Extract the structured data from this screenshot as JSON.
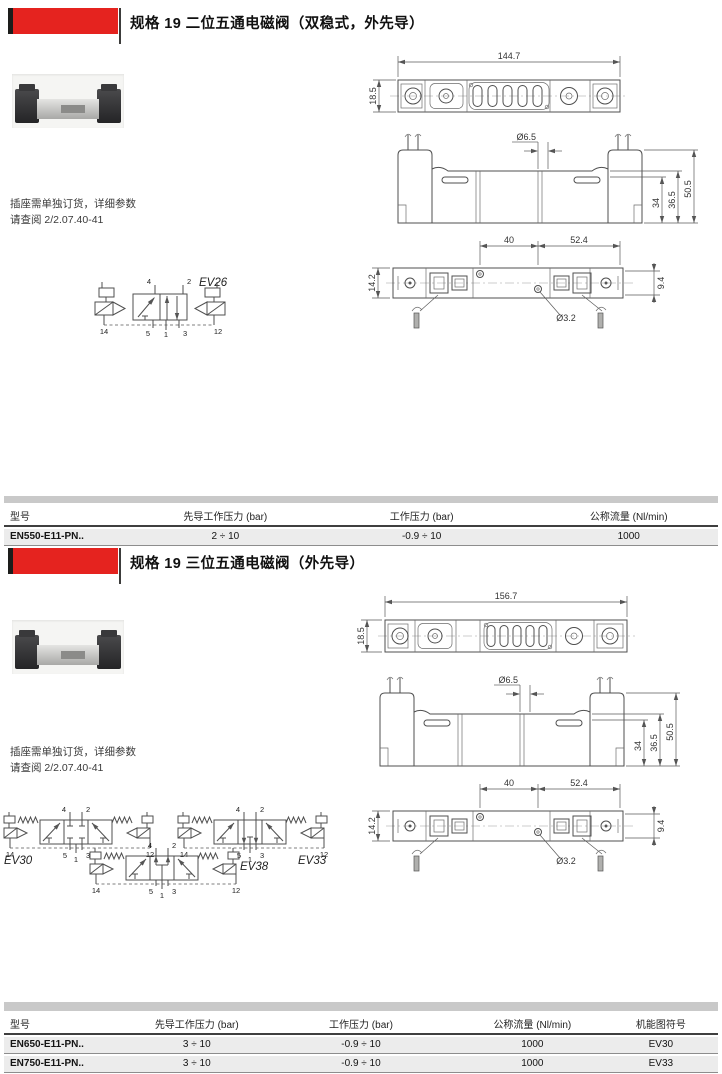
{
  "section1": {
    "title": "规格 19 二位五通电磁阀（双稳式，外先导）",
    "note": {
      "line1": "插座需单独订货，详细参数",
      "line2": "请查阅 2/2.07.40-41"
    },
    "symbol": {
      "label": "EV26",
      "ports_top": [
        "4",
        "2"
      ],
      "ports_bottom": [
        "14",
        "5",
        "1",
        "3",
        "12"
      ]
    },
    "dims": {
      "top_width": "144.7",
      "top_height": "18.5",
      "hole_top": "Ø6.5",
      "h_34": "34",
      "h_36_5": "36.5",
      "h_50_5": "50.5",
      "w_40": "40",
      "w_52_4": "52.4",
      "d_14_2": "14.2",
      "d_9_4": "9.4",
      "hole_bottom": "Ø3.2"
    },
    "table": {
      "headers": [
        "型号",
        "先导工作压力 (bar)",
        "工作压力 (bar)",
        "公称流量 (Nl/min)"
      ],
      "rows": [
        {
          "model": "EN550-E11-PN..",
          "pilot": "2 ÷ 10",
          "working": "-0.9 ÷ 10",
          "flow": "1000"
        }
      ]
    }
  },
  "section2": {
    "title": "规格 19 三位五通电磁阀（外先导）",
    "note": {
      "line1": "插座需单独订货，详细参数",
      "line2": "请查阅 2/2.07.40-41"
    },
    "symbols": [
      {
        "label": "EV30",
        "ports_top": [
          "4",
          "2"
        ],
        "ports_bottom": [
          "14",
          "5",
          "1",
          "3",
          "12"
        ]
      },
      {
        "label": "EV33",
        "ports_top": [
          "4",
          "2"
        ],
        "ports_bottom": [
          "14",
          "5",
          "1",
          "3",
          "12"
        ]
      },
      {
        "label": "EV38",
        "ports_top": [
          "4",
          "2"
        ],
        "ports_bottom": [
          "14",
          "5",
          "1",
          "3",
          "12"
        ]
      }
    ],
    "dims": {
      "top_width": "156.7",
      "top_height": "18.5",
      "hole_top": "Ø6.5",
      "h_34": "34",
      "h_36_5": "36.5",
      "h_50_5": "50.5",
      "w_40": "40",
      "w_52_4": "52.4",
      "d_14_2": "14.2",
      "d_9_4": "9.4",
      "hole_bottom": "Ø3.2"
    },
    "table": {
      "headers": [
        "型号",
        "先导工作压力 (bar)",
        "工作压力 (bar)",
        "公称流量 (Nl/min)",
        "机能图符号"
      ],
      "rows": [
        {
          "model": "EN650-E11-PN..",
          "pilot": "3 ÷ 10",
          "working": "-0.9 ÷ 10",
          "flow": "1000",
          "symbol": "EV30"
        },
        {
          "model": "EN750-E11-PN..",
          "pilot": "3 ÷ 10",
          "working": "-0.9 ÷ 10",
          "flow": "1000",
          "symbol": "EV33"
        },
        {
          "model": "EN850-E11-PN..",
          "pilot": "3 ÷ 10",
          "working": "-0.9 ÷ 10",
          "flow": "1000",
          "symbol": "EV38"
        }
      ]
    }
  }
}
